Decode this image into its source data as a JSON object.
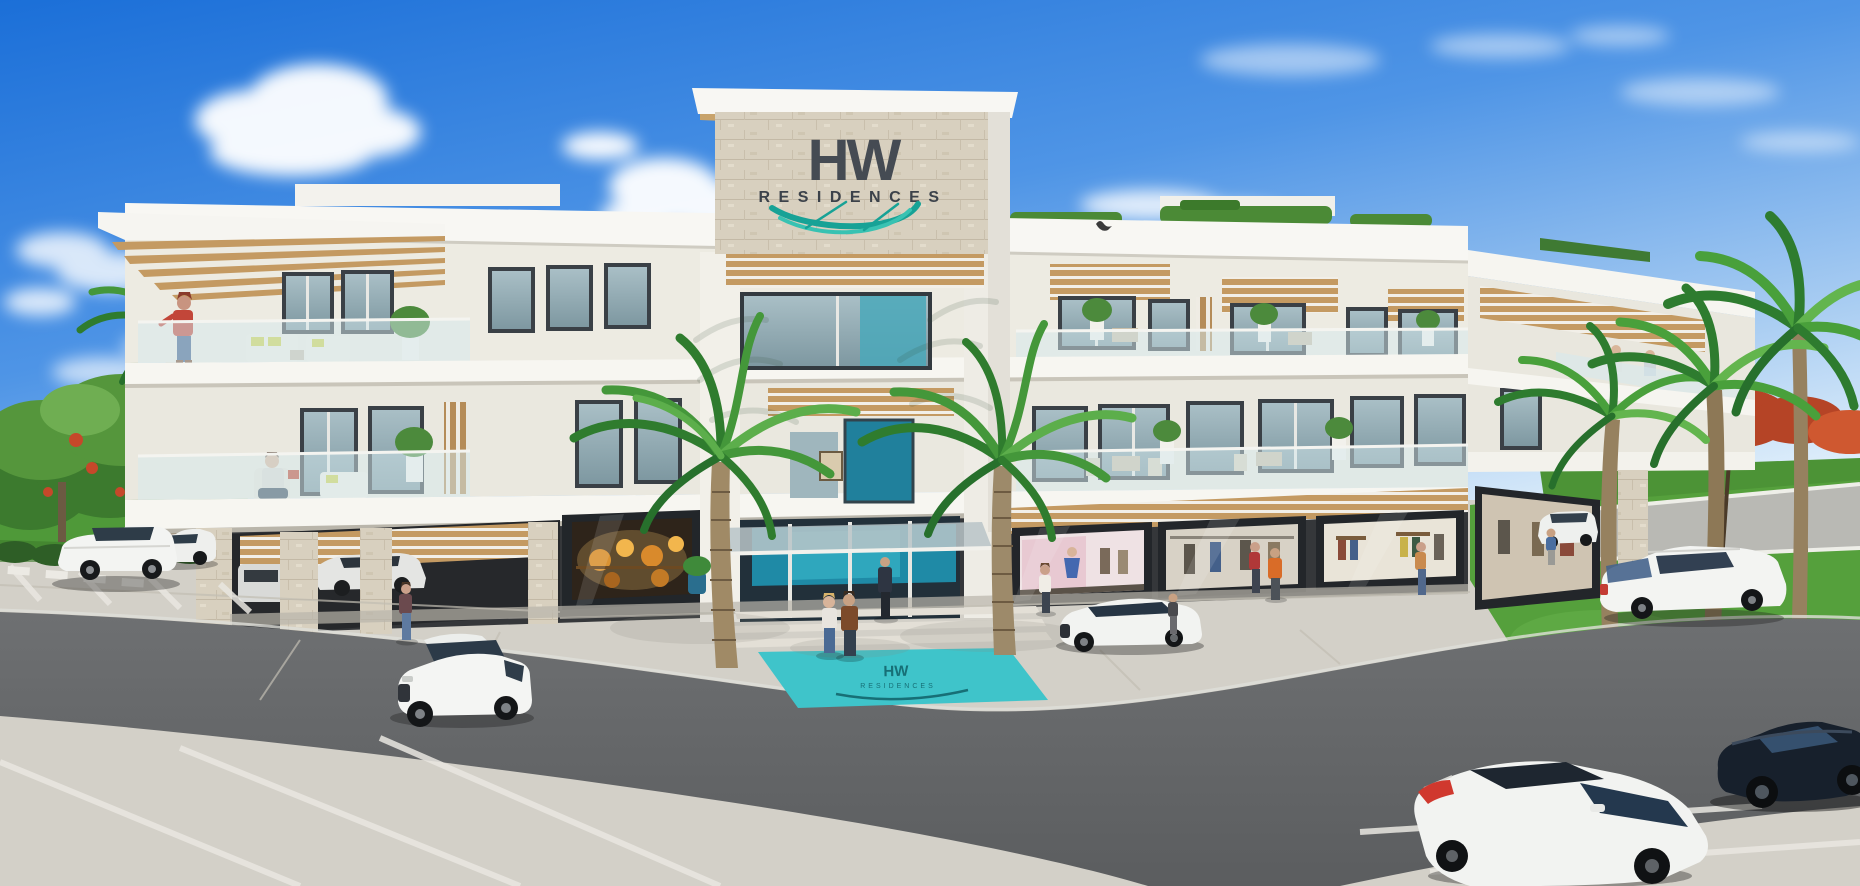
{
  "image": {
    "kind": "3D architectural rendering",
    "subject": "HW Residences - three-story white residential building with ground-floor shops, palm trees, parking lot and cars"
  },
  "sign": {
    "logo": "HW",
    "name": "RESIDENCES"
  },
  "entrance_mat": {
    "logo": "HW",
    "name": "RESIDENCES"
  },
  "colors": {
    "sky_top": "#1b6fd8",
    "sky_light": "#e2f0fb",
    "logo_dark": "#454b53",
    "swoosh_teal": "#17a296",
    "swoosh_teal_light": "#38c2b2",
    "mat_teal": "#3fc4ca",
    "mat_logo_dark": "#176f76",
    "entrance_teal": "#1f8aa6",
    "wood": "#c49a62",
    "stone": "#d8d0bf",
    "building_white": "#f6f5f0",
    "lawn_green": "#4f9939",
    "asphalt": "#67696b",
    "concrete": "#d3d0c8"
  }
}
